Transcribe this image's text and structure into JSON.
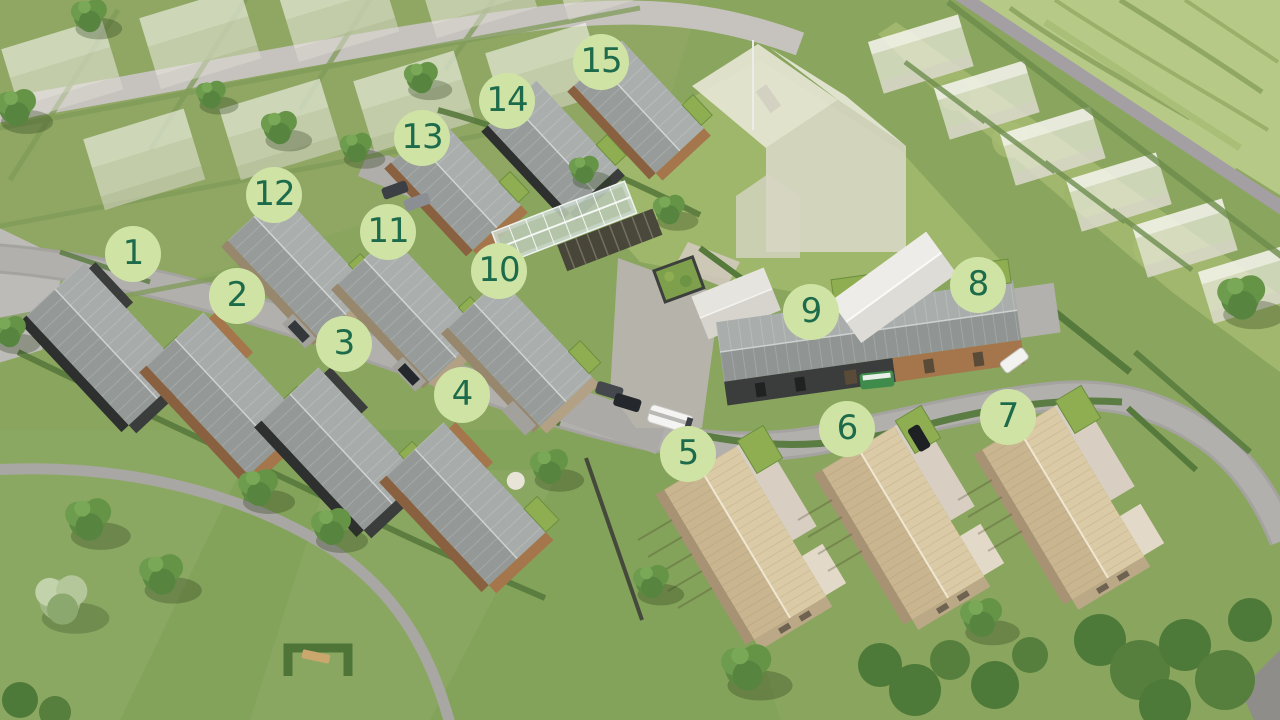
{
  "palette": {
    "marker_fill": "#cfe4a4",
    "marker_number": "#1e6b4c",
    "grass": "#8aa55e",
    "field": "#b6c987",
    "road": "#b2b0ad",
    "dark_house": "#3a3d3c",
    "wood_house": "#a5764c",
    "light_wood_house": "#c9b690",
    "green_roof": "#8fae52"
  },
  "marker_diameter": 56,
  "markers": [
    {
      "label": "1",
      "x": 133,
      "y": 254
    },
    {
      "label": "2",
      "x": 237,
      "y": 296
    },
    {
      "label": "3",
      "x": 344,
      "y": 344
    },
    {
      "label": "4",
      "x": 462,
      "y": 395
    },
    {
      "label": "5",
      "x": 688,
      "y": 454
    },
    {
      "label": "6",
      "x": 847,
      "y": 429
    },
    {
      "label": "7",
      "x": 1008,
      "y": 417
    },
    {
      "label": "8",
      "x": 978,
      "y": 285
    },
    {
      "label": "9",
      "x": 811,
      "y": 312
    },
    {
      "label": "10",
      "x": 499,
      "y": 271
    },
    {
      "label": "11",
      "x": 388,
      "y": 232
    },
    {
      "label": "12",
      "x": 274,
      "y": 195
    },
    {
      "label": "13",
      "x": 422,
      "y": 138
    },
    {
      "label": "14",
      "x": 507,
      "y": 101
    },
    {
      "label": "15",
      "x": 601,
      "y": 62
    }
  ]
}
